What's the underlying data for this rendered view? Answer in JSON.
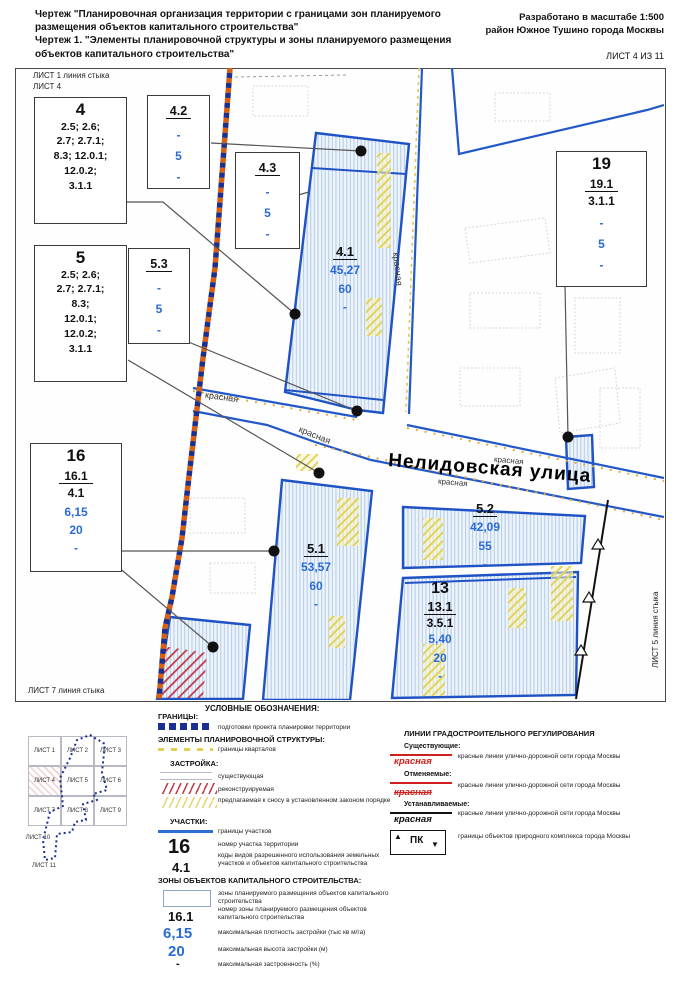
{
  "header": {
    "title_line1": "Чертеж \"Планировочная организация территории с границами зон планируемого",
    "title_line2": "размещения объектов капитального строительства\"",
    "title_line3": "Чертеж 1. \"Элементы планировочной структуры и зоны планируемого размещения",
    "title_line4": "объектов капитального строительства\"",
    "scale_note": "Разработано в масштабе 1:500",
    "district_note": "район Южное Тушино города Москвы",
    "sheet_note": "ЛИСТ 4 ИЗ 11"
  },
  "map": {
    "corner_top1": "ЛИСТ 1 линия стыка",
    "corner_top2": "ЛИСТ 4",
    "corner_bottom": "ЛИСТ 7 линия стыка",
    "corner_right": "ЛИСТ 5 линия стыка",
    "street_name": "Нелидовская улица",
    "red_line_label": "красная",
    "boxes": {
      "b4": {
        "title": "4",
        "lines": [
          "2.5; 2.6;",
          "2.7; 2.7.1;",
          "8.3; 12.0.1;",
          "12.0.2;",
          "3.1.1"
        ]
      },
      "b42": {
        "title": "4.2",
        "dash1": "-",
        "height": "5",
        "dash2": "-"
      },
      "b43": {
        "title": "4.3",
        "dash1": "-",
        "height": "5",
        "dash2": "-"
      },
      "b5": {
        "title": "5",
        "lines": [
          "2.5; 2.6;",
          "2.7; 2.7.1;",
          "8.3;",
          "12.0.1;",
          "12.0.2;",
          "3.1.1"
        ]
      },
      "b53": {
        "title": "5.3",
        "dash1": "-",
        "height": "5",
        "dash2": "-"
      },
      "b16": {
        "title": "16",
        "zone": "16.1",
        "code": "4.1",
        "density": "6,15",
        "height": "20",
        "dash": "-"
      },
      "b19": {
        "title": "19",
        "zone": "19.1",
        "code": "3.1.1",
        "dash1": "-",
        "height": "5",
        "dash2": "-"
      }
    },
    "zones": {
      "z41": {
        "id": "4.1",
        "density": "45,27",
        "height": "60",
        "dash": "-"
      },
      "z51": {
        "id": "5.1",
        "density": "53,57",
        "height": "60",
        "dash": "-"
      },
      "z52": {
        "id": "5.2",
        "density": "42,09",
        "height": "55",
        "dash": "-"
      },
      "z13": {
        "title": "13",
        "id": "13.1",
        "code": "3.5.1",
        "density": "5,40",
        "height": "20",
        "dash": "-"
      }
    }
  },
  "legend": {
    "title": "УСЛОВНЫЕ ОБОЗНАЧЕНИЯ:",
    "granitsy_header": "ГРАНИЦЫ:",
    "granitsy_label": "подготовки проекта планировки территории",
    "elementy_header": "ЭЛЕМЕНТЫ ПЛАНИРОВОЧНОЙ СТРУКТУРЫ:",
    "kvartaly_label": "границы кварталов",
    "zastroika_header": "ЗАСТРОЙКА:",
    "sushch_label": "существующая",
    "rekonstr_label": "реконструируемая",
    "snos_label": "предлагаемая к сносу в установленном законом порядке",
    "uchastki_header": "УЧАСТКИ:",
    "uchastki_granitsy_label": "границы участков",
    "nomer_uchastka_num": "16",
    "nomer_uchastka_label": "номер участка территории",
    "kody_num": "4.1",
    "kody_label": "коды видов разрешенного использования земельных участков и объектов капитального строительства",
    "zony_header": "ЗОНЫ ОБЪЕКТОВ КАПИТАЛЬНОГО СТРОИТЕЛЬСТВА:",
    "zony_label": "зоны планируемого размещения объектов капитального строительства",
    "nomer_zony_num": "16.1",
    "nomer_zony_label": "номер зоны планируемого размещения объектов капитального строительства",
    "plotnost_num": "6,15",
    "plotnost_label": "максимальная плотность застройки (тыс кв м/га)",
    "vysota_num": "20",
    "vysota_label": "максимальная высота застройки (м)",
    "zastroennost_num": "-",
    "zastroennost_label": "максимальная застроенность (%)",
    "lgr_header": "ЛИНИИ ГРАДОСТРОИТЕЛЬНОГО РЕГУЛИРОВАНИЯ",
    "sushchestvuyushchie_header": "Существующие:",
    "otmenyaemye_header": "Отменяемые:",
    "ustanavlivaemye_header": "Устанавливаемые:",
    "krasnaya": "красная",
    "krasnye_linii_label": "красные линии улично-дорожной сети города Москвы",
    "pk_label": "ПК",
    "pk_up_icon": "▲",
    "pk_down_icon": "▼",
    "pk_desc": "границы объектов природного комплекса города Москвы"
  },
  "minimap": {
    "sheets": [
      "ЛИСТ 1",
      "ЛИСТ 2",
      "ЛИСТ 3",
      "ЛИСТ 4",
      "ЛИСТ 5",
      "ЛИСТ 6",
      "ЛИСТ 7",
      "ЛИСТ 8",
      "ЛИСТ 9"
    ],
    "sheet10": "ЛИСТ 10",
    "sheet11": "ЛИСТ 11"
  },
  "colors": {
    "zone_border": "#1f52c5",
    "zone_fill_stripe": "#b7cde9",
    "boundary_orange": "#d86010",
    "boundary_navy": "#1a2f8f",
    "value_blue": "#2b6bd4",
    "red_line": "#cf1f1f"
  }
}
